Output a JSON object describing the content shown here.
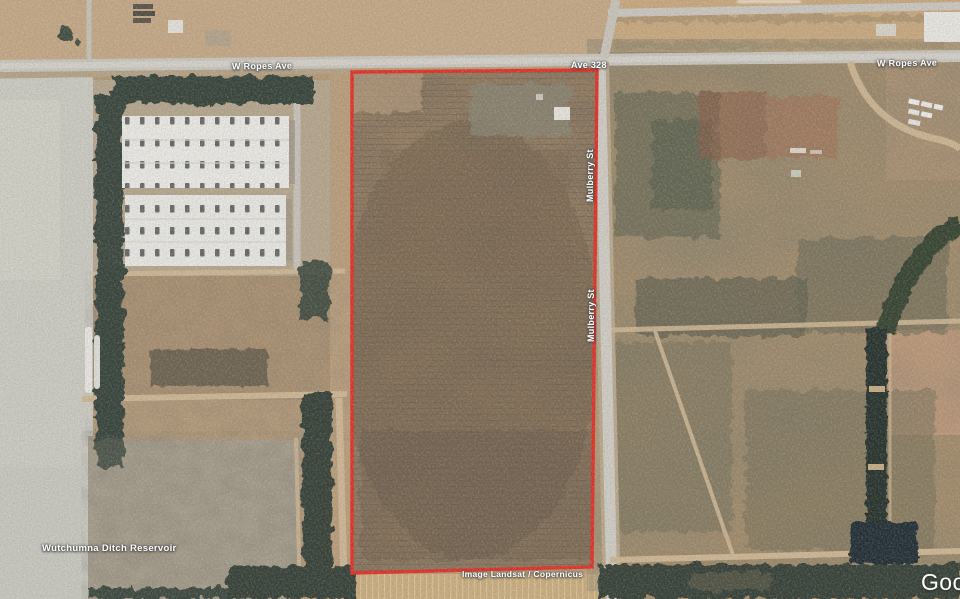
{
  "map": {
    "road_labels": {
      "ropes_left": "W Ropes Ave",
      "ave_328": "Ave 328",
      "ropes_right": "W Ropes Ave",
      "mulberry_upper": "Mulberry St",
      "mulberry_lower": "Mulberry St"
    },
    "place_labels": {
      "reservoir": "Wutchumna Ditch Reservoir"
    },
    "attribution": "Image Landsat / Copernicus",
    "logo": "Google",
    "parcel_outline": {
      "color": "#e32b22"
    }
  }
}
